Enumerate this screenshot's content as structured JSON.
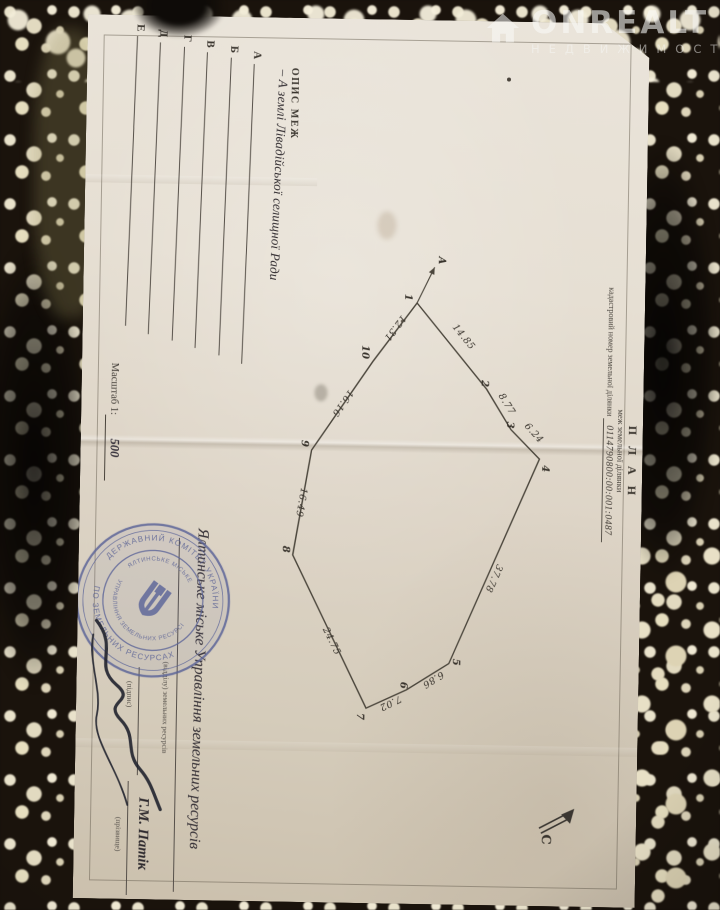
{
  "watermark": {
    "brand": "ONREALT",
    "subtitle": "НЕДВИЖИМОСТЬ"
  },
  "document": {
    "header": {
      "title": "П Л А Н",
      "subtitle": "меж земельної ділянки",
      "cadastral_label": "кадастровий номер земельної ділянки",
      "cadastral_number": "0114790800:00:001:0487"
    },
    "boundary_description": {
      "title": "ОПИС МЕЖ",
      "rows": [
        {
          "letter": "А",
          "entry": "– А землі Лівадійської селищної Ради"
        },
        {
          "letter": "Б",
          "entry": ""
        },
        {
          "letter": "В",
          "entry": ""
        },
        {
          "letter": "Г",
          "entry": ""
        },
        {
          "letter": "Д",
          "entry": ""
        },
        {
          "letter": "Е",
          "entry": ""
        }
      ]
    },
    "scale": {
      "label": "Масштаб 1:",
      "value": "500"
    },
    "compass_label": "С",
    "plan": {
      "vertices": [
        {
          "n": "1",
          "x": 283,
          "y": 228,
          "lx": 274,
          "ly": 240
        },
        {
          "n": "2",
          "x": 368,
          "y": 157,
          "lx": 359,
          "ly": 162
        },
        {
          "n": "3",
          "x": 408,
          "y": 132,
          "lx": 400,
          "ly": 136
        },
        {
          "n": "4",
          "x": 437,
          "y": 103,
          "lx": 443,
          "ly": 100
        },
        {
          "n": "5",
          "x": 643,
          "y": 190,
          "lx": 638,
          "ly": 186
        },
        {
          "n": "6",
          "x": 670,
          "y": 232,
          "lx": 662,
          "ly": 238
        },
        {
          "n": "7",
          "x": 689,
          "y": 272,
          "lx": 694,
          "ly": 281
        },
        {
          "n": "8",
          "x": 537,
          "y": 348,
          "lx": 528,
          "ly": 358
        },
        {
          "n": "9",
          "x": 432,
          "y": 331,
          "lx": 422,
          "ly": 341
        },
        {
          "n": "10",
          "x": 342,
          "y": 271,
          "lx": 326,
          "ly": 282
        }
      ],
      "edges": [
        {
          "length": "14.85",
          "lx": 318,
          "ly": 183,
          "angle": -40
        },
        {
          "length": "8.77",
          "lx": 384,
          "ly": 139,
          "angle": -33
        },
        {
          "length": "6.24",
          "lx": 413,
          "ly": 111,
          "angle": -43
        },
        {
          "length": "37.78",
          "lx": 556,
          "ly": 149,
          "angle": 23
        },
        {
          "length": "6.86",
          "lx": 657,
          "ly": 207,
          "angle": 57
        },
        {
          "length": "7.02",
          "lx": 681,
          "ly": 249,
          "angle": 63
        },
        {
          "length": "24.75",
          "lx": 624,
          "ly": 310,
          "angle": -27
        },
        {
          "length": "16.49",
          "lx": 484,
          "ly": 343,
          "angle": 9
        },
        {
          "length": "16.16",
          "lx": 383,
          "ly": 303,
          "angle": 34
        },
        {
          "length": "12.31",
          "lx": 307,
          "ly": 252,
          "angle": 36
        }
      ],
      "arrow": {
        "x1": 283,
        "y1": 228,
        "x2": 247,
        "y2": 211,
        "label": "А",
        "lx": 236,
        "ly": 207
      }
    },
    "stamp": {
      "ring_top": "ДЕРЖАВНИЙ КОМІТЕТ УКРАЇНИ",
      "ring_bottom": "ПО ЗЕМЕЛЬНИХ РЕСУРСАХ",
      "inner_top": "ЯЛТИНСЬКЕ МІСЬКЕ",
      "inner_bottom": "УПРАВЛІННЯ ЗЕМЕЛЬНИХ РЕСУРСІВ"
    },
    "signoff": {
      "org_entry": "Ялтинське міське Управління земельних ресурсів",
      "org_caption": "(відділу) земельних ресурсів",
      "signature_caption": "(підпис)",
      "name": "Г.М. Патік",
      "name_caption": "(прізвище)"
    }
  },
  "colors": {
    "stamp_ink": "#5a6398",
    "pen_ink": "#20222e",
    "paper_text": "#3c3731"
  }
}
